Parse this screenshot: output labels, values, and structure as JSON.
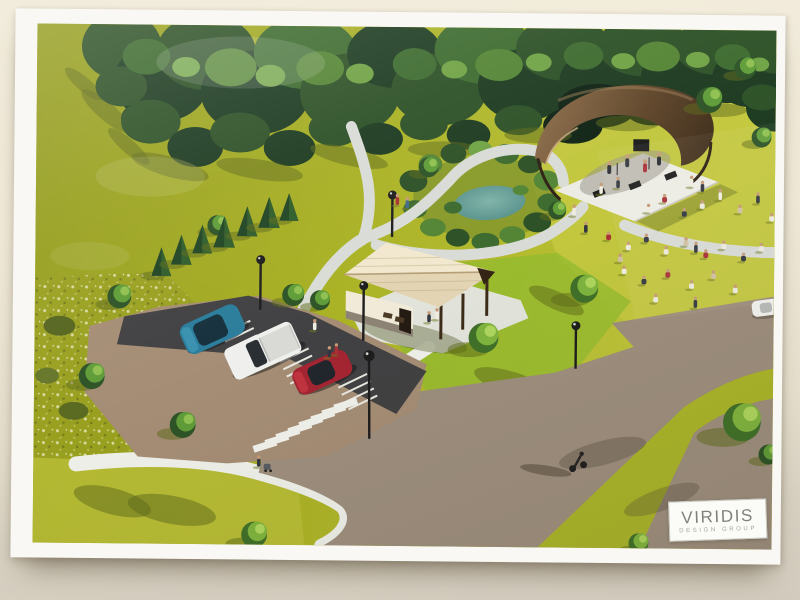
{
  "poster": {
    "logo": {
      "title": "VIRIDIS",
      "subtitle": "Design Group"
    }
  },
  "colors": {
    "paper": "#f9f8f4",
    "wall-top": "#f2ecdc",
    "wall-bottom": "#d3ccbe",
    "grass-olive": "#99a120",
    "grass-mid": "#abb226",
    "grass-bright": "#c6cb42",
    "grass-green": "#93bb2f",
    "forest-dark": "#1c3a20",
    "forest-mid": "#2c5026",
    "forest-light": "#538434",
    "pond": "#5a948f",
    "path": "#d9dcd6",
    "sidewalk": "#eef0e9",
    "road": "#9d8e7d",
    "parking": "#a58d75",
    "asphalt": "#414042",
    "stripe": "#f1f1ec",
    "car-teal": "#2a7d9b",
    "car-white": "#eff0ed",
    "car-red": "#a32531",
    "pavilion-roof": "#f0e6cd",
    "pavilion-wood": "#3d2b1a",
    "bandshell-canopy": "#6f5233",
    "stage": "#ecebe4",
    "lamp": "#1d1d1d"
  }
}
